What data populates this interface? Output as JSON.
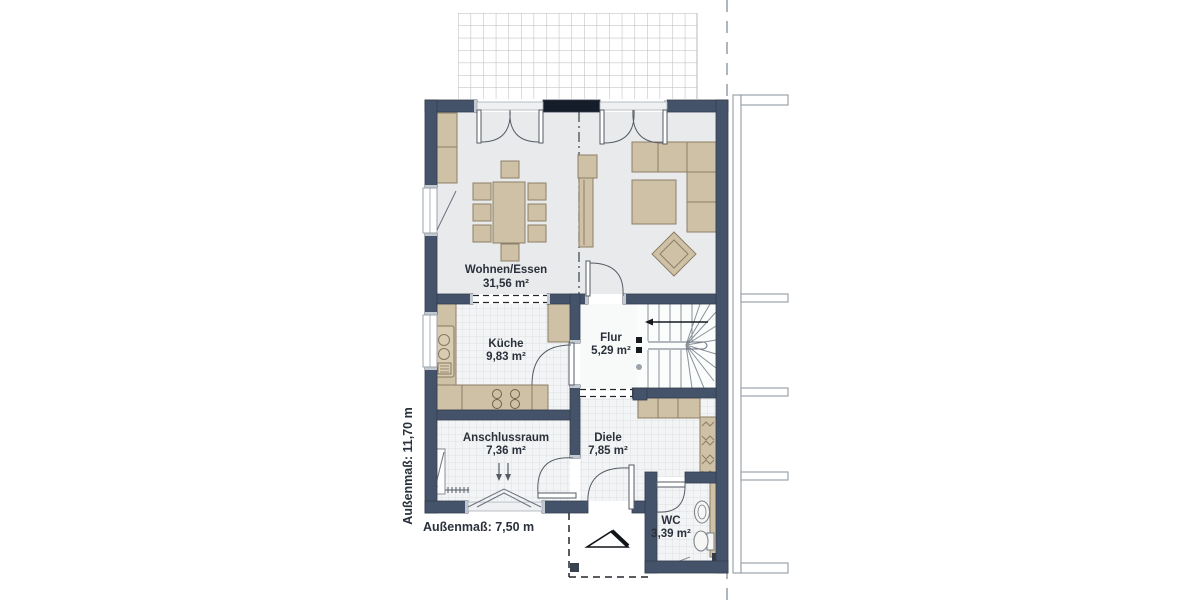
{
  "plan": {
    "title": "Erdgeschoss Grundriss (Doppelhaushälfte)",
    "rooms": [
      {
        "id": "wohnen-essen",
        "name": "Wohnen/Essen",
        "area": "31,56 m²"
      },
      {
        "id": "kueche",
        "name": "Küche",
        "area": "9,83 m²"
      },
      {
        "id": "flur",
        "name": "Flur",
        "area": "5,29 m²"
      },
      {
        "id": "anschlussraum",
        "name": "Anschlussraum",
        "area": "7,36 m²"
      },
      {
        "id": "diele",
        "name": "Diele",
        "area": "7,85 m²"
      },
      {
        "id": "wc",
        "name": "WC",
        "area": "3,39 m²"
      }
    ],
    "dimensions": {
      "width_label": "Außenmaß: 7,50 m",
      "height_label": "Außenmaß: 11,70 m"
    },
    "colors": {
      "wall": "#45536a",
      "lintel": "#161d2a",
      "furniture": "#cfc1a6",
      "furniture_stroke": "#8d7f66",
      "floor_living": "#e9eaec",
      "floor_tile": "#f3f4f5",
      "tile_line": "#dcdfe1",
      "terrace_line": "#b7babd",
      "outline_gray": "#9aa3ab",
      "text": "#2b313b"
    }
  }
}
